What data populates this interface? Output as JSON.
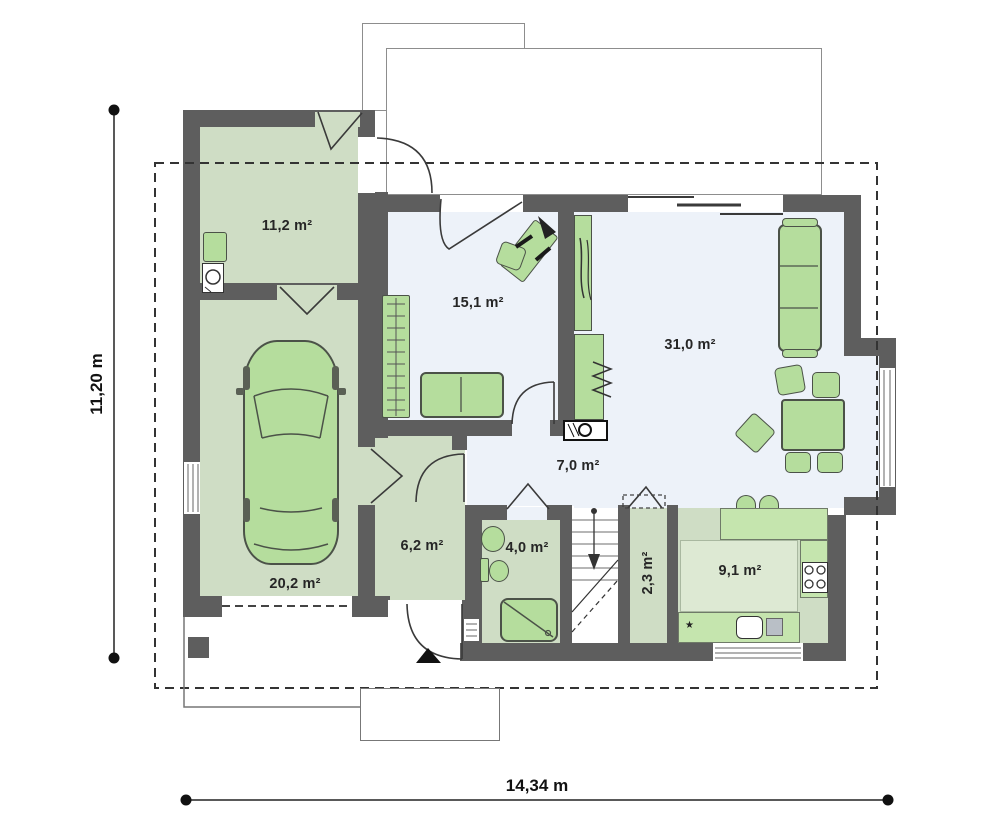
{
  "plan": {
    "type": "architectural-floor-plan",
    "floor_label": "ground floor",
    "rooms": [
      {
        "id": "utility",
        "label": "11,2 m²"
      },
      {
        "id": "bedroom",
        "label": "15,1 m²"
      },
      {
        "id": "living",
        "label": "31,0 m²"
      },
      {
        "id": "hall",
        "label": "7,0 m²"
      },
      {
        "id": "vestibule",
        "label": "6,2 m²"
      },
      {
        "id": "bathroom",
        "label": "4,0 m²"
      },
      {
        "id": "pantry",
        "label": "2,3 m²"
      },
      {
        "id": "kitchen",
        "label": "9,1 m²"
      },
      {
        "id": "garage",
        "label": "20,2 m²"
      }
    ],
    "dimensions": {
      "width_label": "14,34 m",
      "height_label": "11,20 m"
    },
    "symbols": {
      "entrance_marker": "black-triangle-arrow",
      "kitchen_star": "★"
    },
    "colors": {
      "wall": "#5e5e5e",
      "room_sage": "#cfddc5",
      "room_light": "#edf2f9",
      "furniture_green": "#b5dd9d",
      "counter_green": "#c5e5ae",
      "outline_gray": "#8d8d8d",
      "line_dark": "#3a3a3a"
    }
  }
}
